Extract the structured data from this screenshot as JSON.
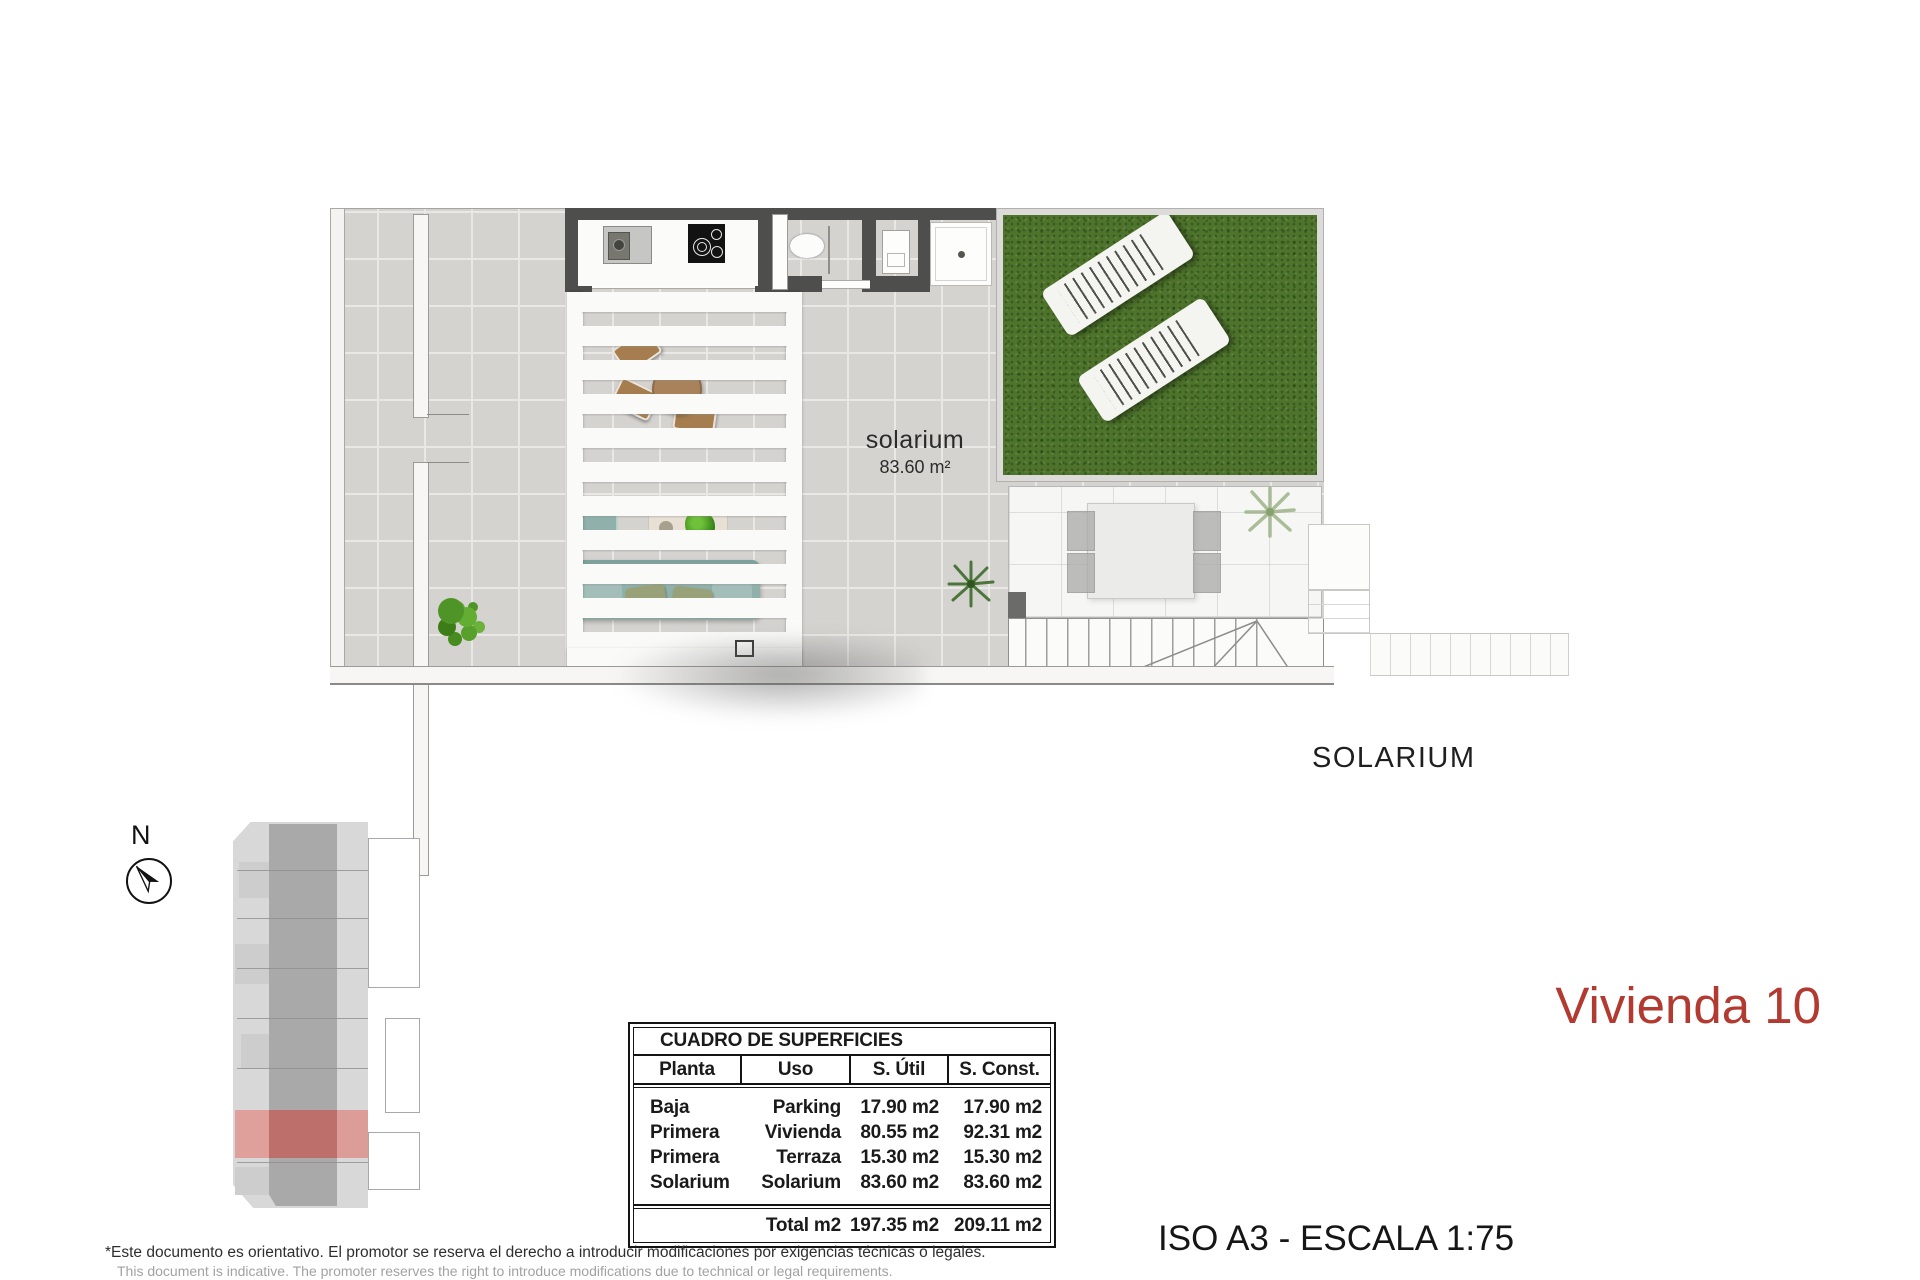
{
  "colors": {
    "accent_red": "#b23a31",
    "grass_green": "#4e742b",
    "wall_gray": "#4e4e4c",
    "site_red": "#bd6f6b"
  },
  "plan": {
    "room_label": "solarium",
    "room_area": "83.60 m²",
    "floor_caption": "SOLARIUM"
  },
  "compass": {
    "label": "N",
    "icon": "north-arrow-icon"
  },
  "unit_title": {
    "text": "Vivienda 10"
  },
  "scale_note": {
    "text": "ISO A3 - ESCALA 1:75"
  },
  "surfaces_table": {
    "title": "CUADRO DE SUPERFICIES",
    "columns": [
      "Planta",
      "Uso",
      "S. Útil",
      "S. Const."
    ],
    "rows": [
      {
        "planta": "Baja",
        "uso": "Parking",
        "util": "17.90 m2",
        "const": "17.90 m2"
      },
      {
        "planta": "Primera",
        "uso": "Vivienda",
        "util": "80.55 m2",
        "const": "92.31 m2"
      },
      {
        "planta": "Primera",
        "uso": "Terraza",
        "util": "15.30 m2",
        "const": "15.30 m2"
      },
      {
        "planta": "Solarium",
        "uso": "Solarium",
        "util": "83.60 m2",
        "const": "83.60 m2"
      }
    ],
    "total": {
      "label": "Total m2",
      "util": "197.35 m2",
      "const": "209.11 m2"
    }
  },
  "disclaimer": {
    "es": "*Este documento es orientativo. El promotor se reserva el derecho a introducir modificaciones por exigencias técnicas o legales.",
    "en": "This document is indicative. The promoter reserves the right to introduce modifications due to technical or legal requirements."
  }
}
